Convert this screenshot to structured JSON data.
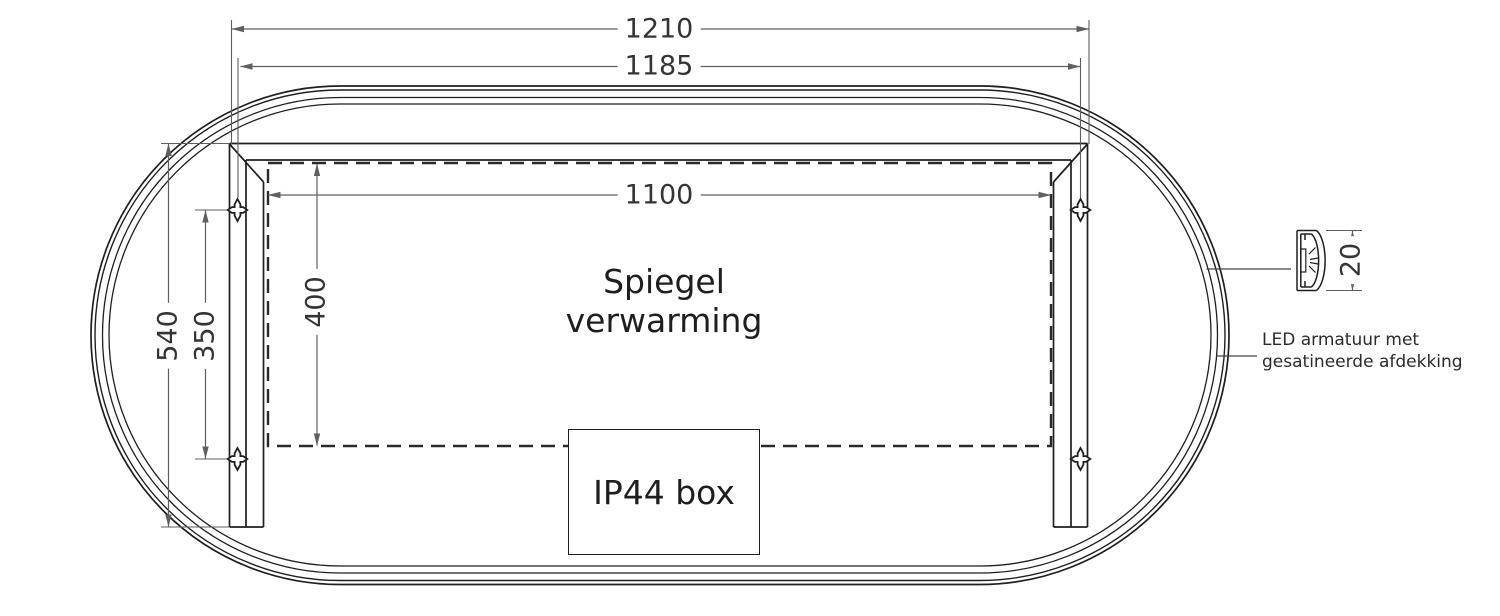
{
  "drawing": {
    "type": "technical-drawing",
    "subject": "oval mirror rear view with heating foil, mounting brackets, IP44 box and LED profile section",
    "units": "mm",
    "dimensions": {
      "width_overall": "1210",
      "width_mounting_holes": "1185",
      "width_heating_foil": "1100",
      "height_bracket": "540",
      "height_mounting_holes": "350",
      "height_heating_foil": "400",
      "led_profile_depth": "20"
    },
    "labels": {
      "heating_line1": "Spiegel",
      "heating_line2": "verwarming",
      "junction_box": "IP44 box",
      "led_note_line1": "LED armatuur met",
      "led_note_line2": "gesatineerde afdekking"
    },
    "colors": {
      "background": "#ffffff",
      "outline": "#1f1f1f",
      "dimension_lines": "#5f5f5f",
      "text": "#343434"
    }
  }
}
